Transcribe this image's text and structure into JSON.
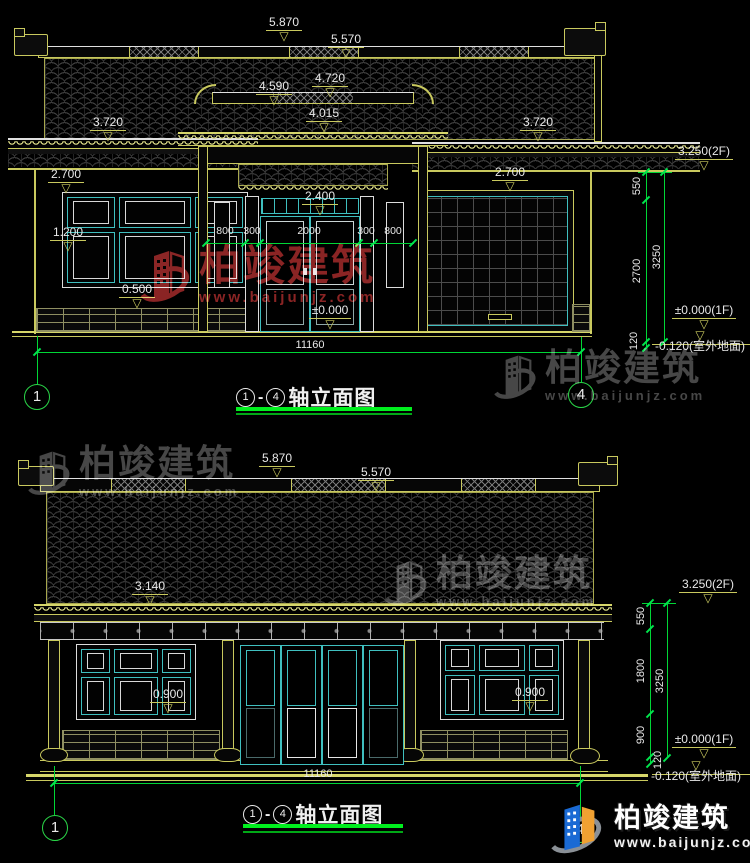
{
  "watermark": {
    "brand": "柏竣建筑",
    "url": "www.baijunjz.com"
  },
  "footer_logo": {
    "brand": "柏竣建筑",
    "url": "www.baijunjz.com"
  },
  "elevation_front": {
    "title": {
      "axis_from": "1",
      "dash": "-",
      "axis_to": "4",
      "text": "轴立面图"
    },
    "axis_bubble_left": "1",
    "axis_bubble_right": "4",
    "levels": {
      "main_ridge": "5.870",
      "ridge_step": "5.570",
      "gate_finial": "4.720",
      "gate_ridge": "4.590",
      "gate_eave": "4.015",
      "eave_left": "3.720",
      "eave_right": "3.720",
      "lintel_left": "2.700",
      "lintel_right": "2.700",
      "door_head": "2.400",
      "sill_left": "1.200",
      "base_left": "0.500",
      "floor": "±0.000"
    },
    "h_dims": {
      "items": [
        "800",
        "300",
        "2000",
        "300",
        "800"
      ],
      "total": "11160"
    },
    "right_chain": {
      "top_level": "3.250(2F)",
      "seg1": "550",
      "seg2": "2700",
      "seg3": "120",
      "total": "3250",
      "floor_level": "±0.000(1F)",
      "ground_level": "-0.120(室外地面)"
    }
  },
  "elevation_rear": {
    "title": {
      "axis_from": "1",
      "dash": "-",
      "axis_to": "4",
      "text": "轴立面图"
    },
    "axis_bubble_left": "1",
    "axis_bubble_right": "4",
    "levels": {
      "main_ridge": "5.870",
      "ridge_step": "5.570",
      "eave": "3.140",
      "sill_left": "0.900",
      "sill_right": "0.900"
    },
    "h_dims": {
      "total": "11160"
    },
    "right_chain": {
      "top_level": "3.250(2F)",
      "seg1": "550",
      "seg2": "1800",
      "seg3": "900",
      "seg4": "120",
      "total": "3250",
      "floor_level": "±0.000(1F)",
      "ground_level": "-0.120(室外地面)"
    }
  }
}
